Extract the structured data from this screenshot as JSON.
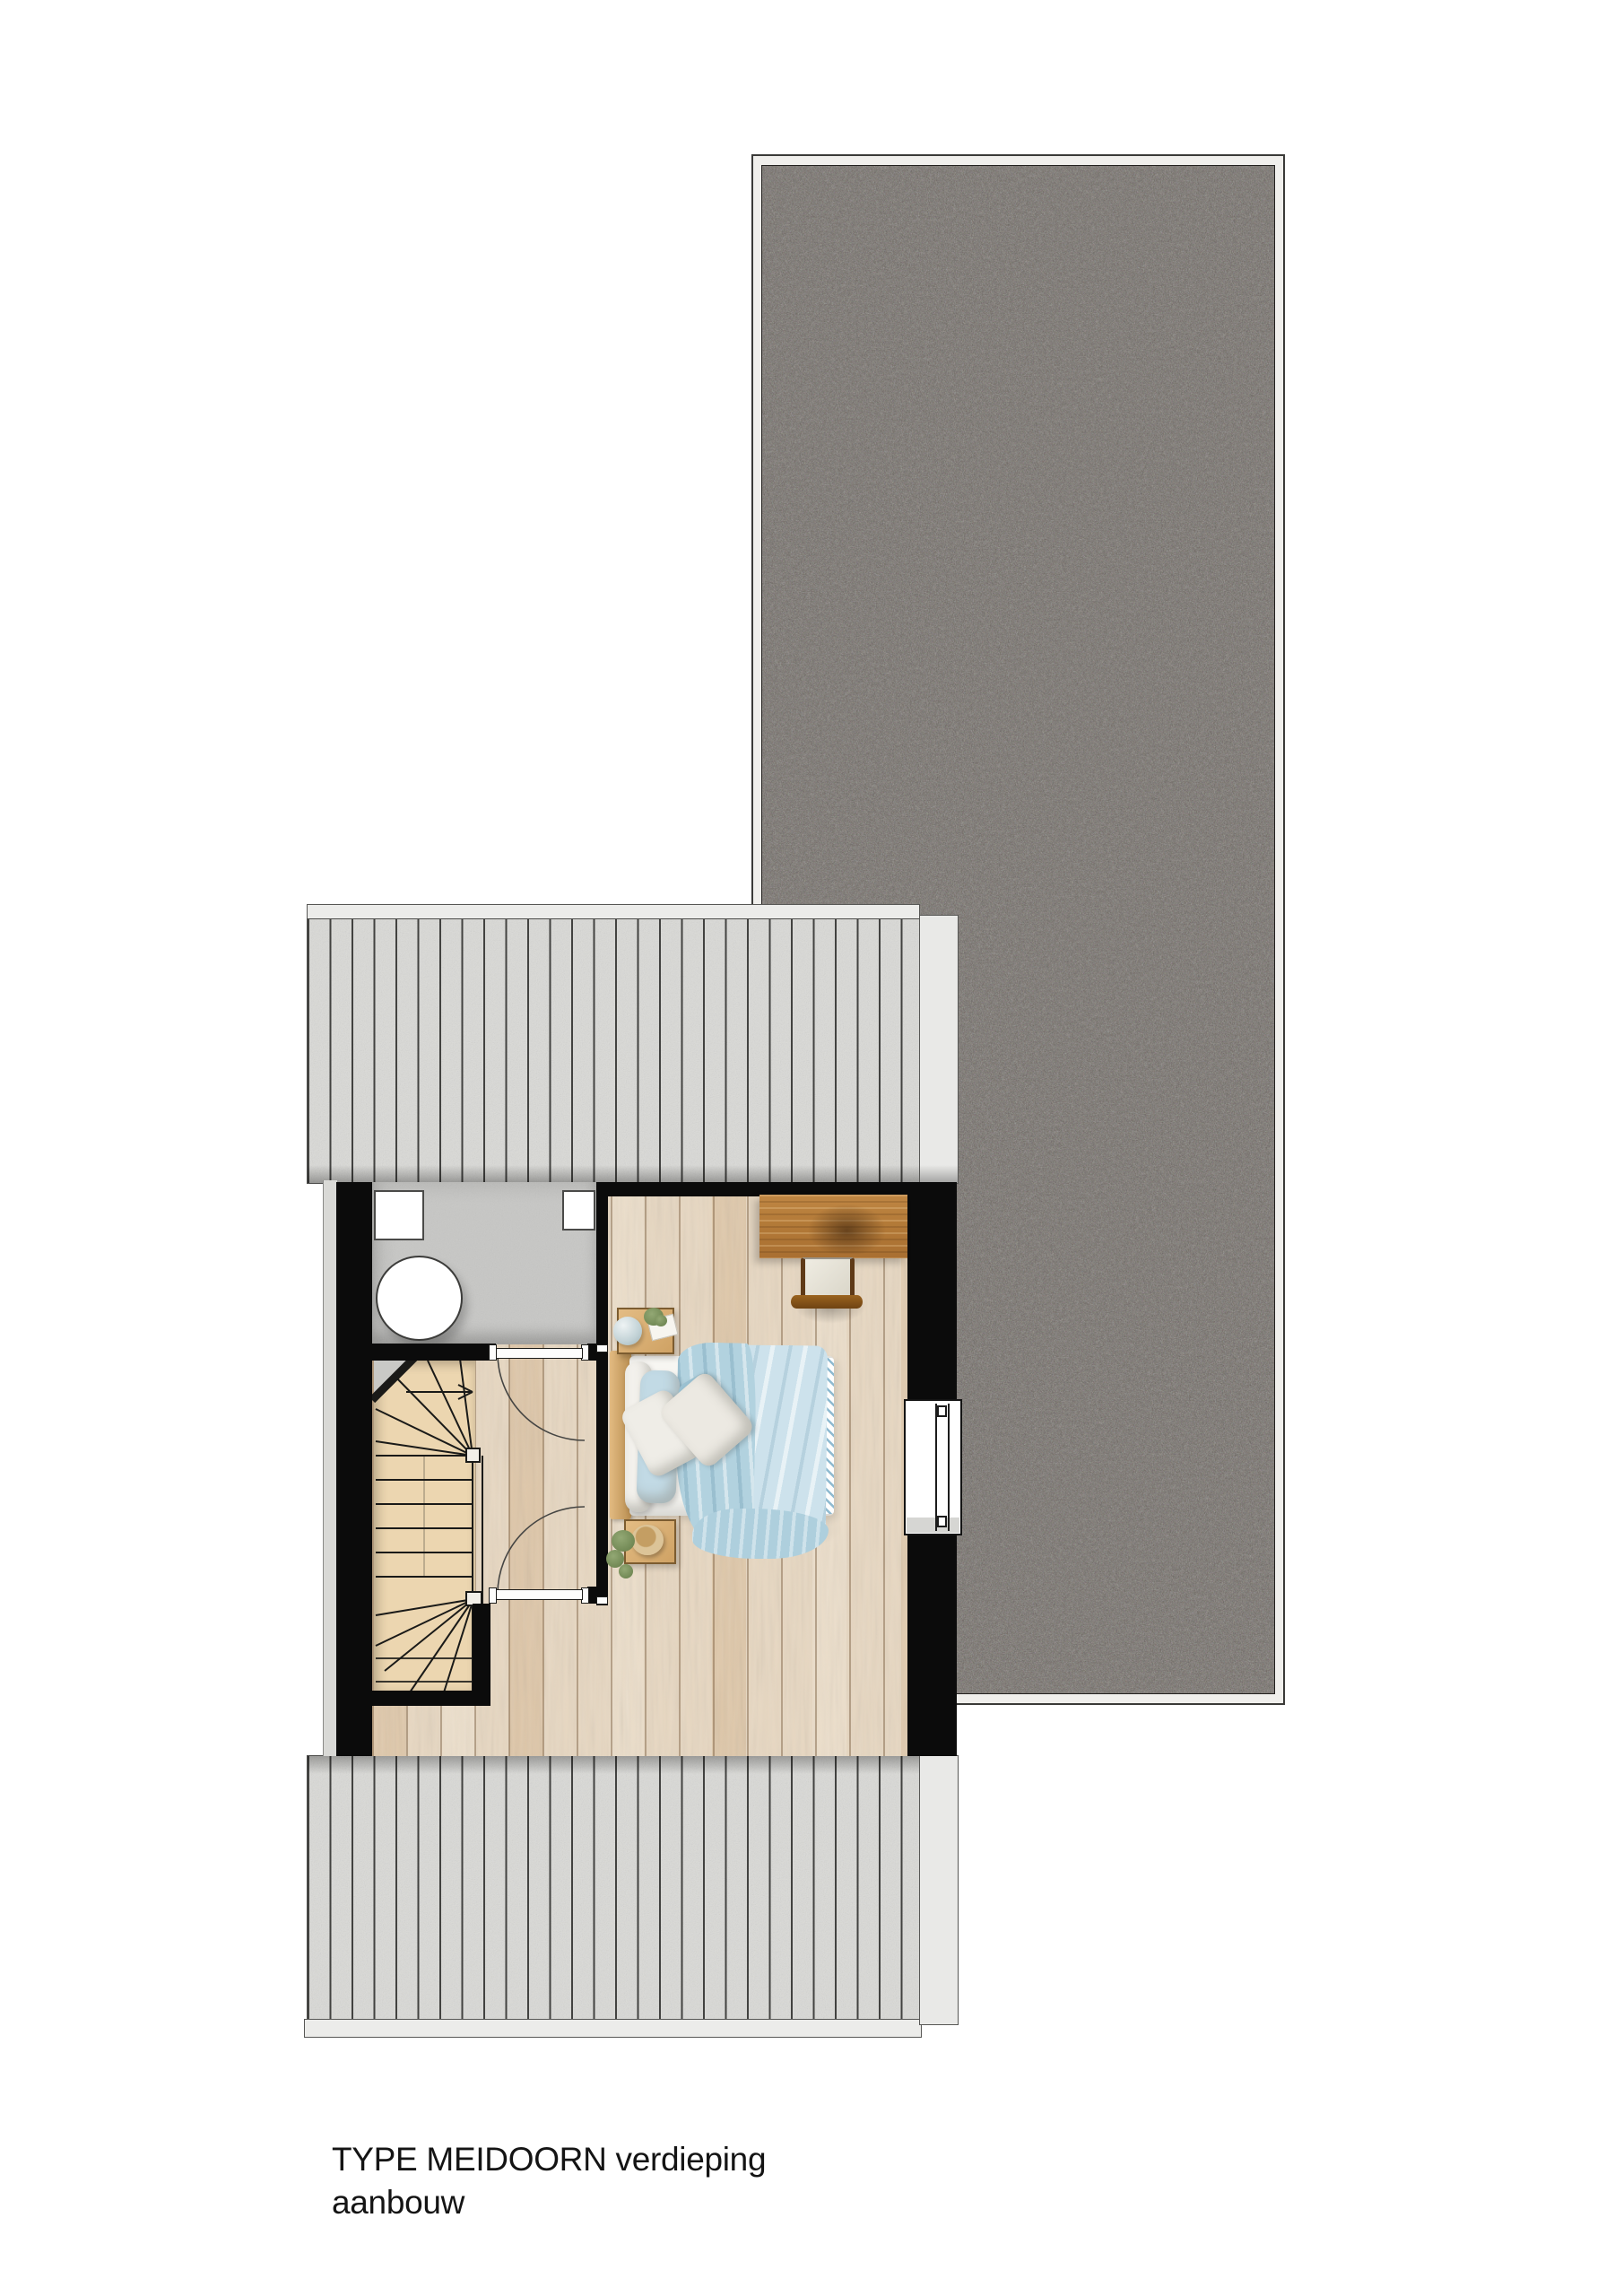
{
  "caption": {
    "line1": "TYPE MEIDOORN verdieping",
    "line2": "aanbouw"
  },
  "plan": {
    "type": "architectural-floor-plan-top-view",
    "level": "verdieping (upper floor of extension)",
    "rooms": [
      {
        "name": "bedroom",
        "floor_finish": "light wood planks"
      },
      {
        "name": "bathroom",
        "floor_finish": "grey screed",
        "fixtures": [
          "toilet-bowl",
          "white-unit-left",
          "white-unit-right"
        ]
      },
      {
        "name": "landing",
        "floor_finish": "light wood planks",
        "doors": 2
      },
      {
        "name": "stairwell",
        "feature": "winder-staircase-with-up-arrow"
      }
    ],
    "openings": [
      "bathroom-door-with-swing-arc",
      "landing-door-with-swing-arc",
      "window-right-wall"
    ],
    "furniture": [
      "double-bed",
      "wood-headboard",
      "white-pillows",
      "blue-pillows",
      "blue-duvet",
      "patterned-runner",
      "nightstand-north",
      "nightstand-south",
      "glass-vase",
      "book",
      "plant",
      "straw-hat",
      "desk",
      "desk-chair"
    ],
    "roofs": [
      "dark-gravel-flat-roof-east",
      "light-seamed-roof-north",
      "light-seamed-roof-south"
    ]
  },
  "colors": {
    "page_background": "#ffffff",
    "wall_black": "#0b0b0b",
    "gravel_roof": "#5d564f",
    "seamed_roof": "#dadad7",
    "wood_floor": "#e7d7c1",
    "bathroom_floor": "#c7c7c5",
    "stair_wood": "#ecd6b0",
    "duvet_blue": "#b2d2df",
    "desk_wood": "#b37a38",
    "caption_text": "#141414"
  }
}
